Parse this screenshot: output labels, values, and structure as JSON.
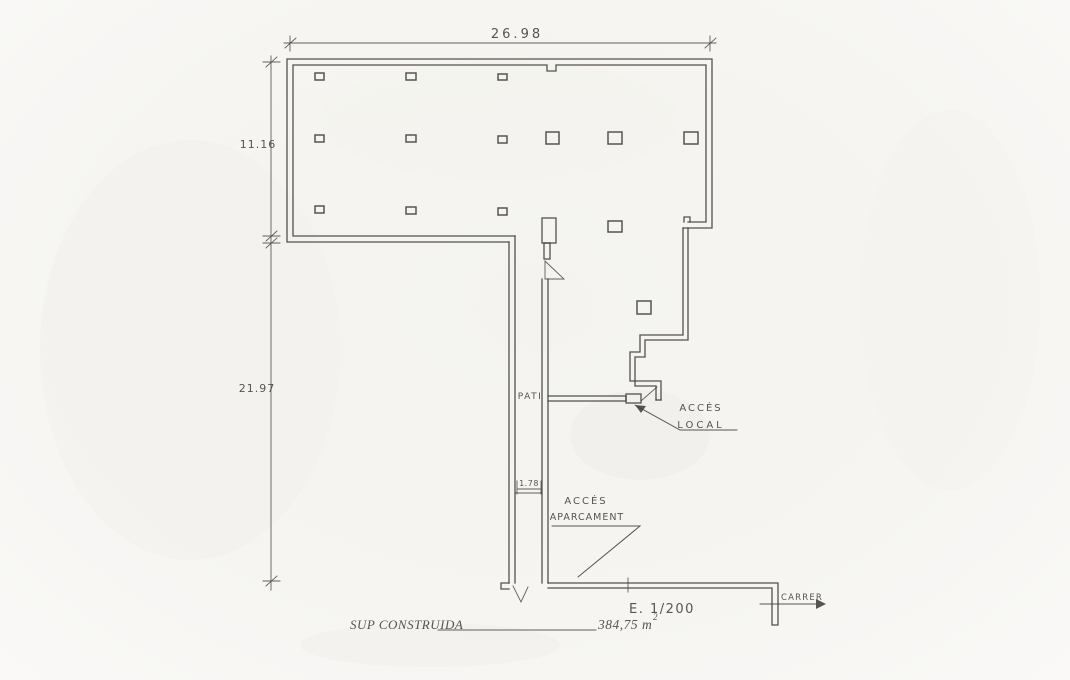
{
  "canvas": {
    "paper_color": "#f6f5f2",
    "ink_color": "#46433f"
  },
  "dimensions": {
    "top_width": "26.98",
    "upper_left_height": "11.16",
    "lower_left_height": "21.97",
    "pati_width": "1.78"
  },
  "labels": {
    "pati": "PATI",
    "acces_local_line1": "ACCÉS",
    "acces_local_line2": "LOCAL",
    "acces_aparcament_line1": "ACCÉS",
    "acces_aparcament_line2": "APARCAMENT",
    "carrer": "CARRER",
    "scale": "E. 1/200"
  },
  "footer": {
    "area_label": "SUP CONSTRUIDA",
    "area_value": "384,75 m",
    "area_exponent": "2"
  }
}
